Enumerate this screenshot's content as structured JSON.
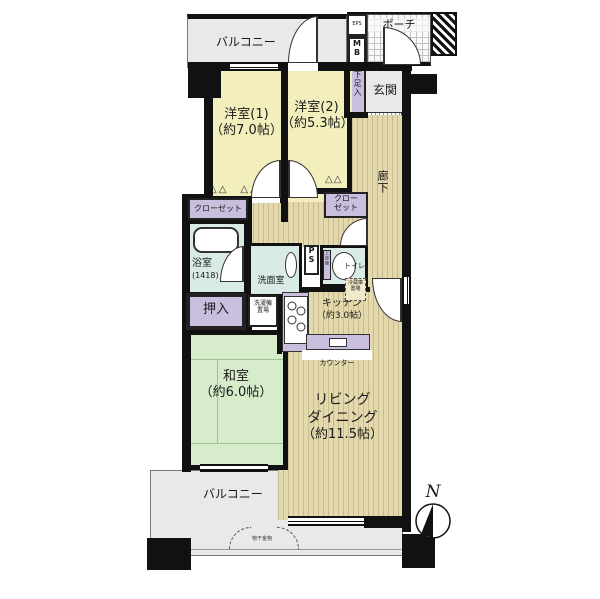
{
  "rooms": {
    "balcony_top": {
      "label": "バルコニー"
    },
    "eps": {
      "label": "EPS"
    },
    "mb": {
      "label": "MB"
    },
    "porch": {
      "label": "ポーチ"
    },
    "entrance": {
      "label": "玄関"
    },
    "shoe_cabinet": {
      "label": "下足入"
    },
    "bedroom1": {
      "name": "洋室(1)",
      "size": "（約7.0帖）"
    },
    "bedroom2": {
      "name": "洋室(2)",
      "size": "（約5.3帖）"
    },
    "corridor": {
      "label": "廊下"
    },
    "closet1": {
      "label": "クローゼット"
    },
    "closet2": {
      "label": "クローゼット"
    },
    "bathroom": {
      "name": "浴室",
      "size": "(1418)"
    },
    "washroom": {
      "label": "洗面室"
    },
    "pipe_space": {
      "label": "PS"
    },
    "upper_shelf": {
      "label": "上部棚"
    },
    "toilet": {
      "label": "トイレ"
    },
    "oshiire": {
      "label": "押入"
    },
    "laundry_space": {
      "label": "洗濯機置場"
    },
    "fridge_space": {
      "label": "冷蔵庫置場"
    },
    "kitchen": {
      "name": "キッチン",
      "size": "（約3.0帖）"
    },
    "counter": {
      "label": "カウンター"
    },
    "washitsu": {
      "name": "和室",
      "size": "（約6.0帖）"
    },
    "living": {
      "line1": "リビング",
      "line2": "ダイニング",
      "line3": "（約11.5帖）"
    },
    "balcony_bottom": {
      "label": "バルコニー"
    },
    "laundry_hardware": {
      "label": "物干金物"
    }
  },
  "compass": {
    "label": "N"
  },
  "icons": {
    "folding_door_marks_wide": "△△　△△",
    "folding_door_marks_small": "△△"
  },
  "colors": {
    "wall": "#111111",
    "wood_floor": "#e3d9ad",
    "tatami": "#d6ecca",
    "western_room": "#f2efbd",
    "wet_area": "#d8ebe7",
    "storage": "#c9bedd",
    "balcony": "#e9e9e9"
  }
}
